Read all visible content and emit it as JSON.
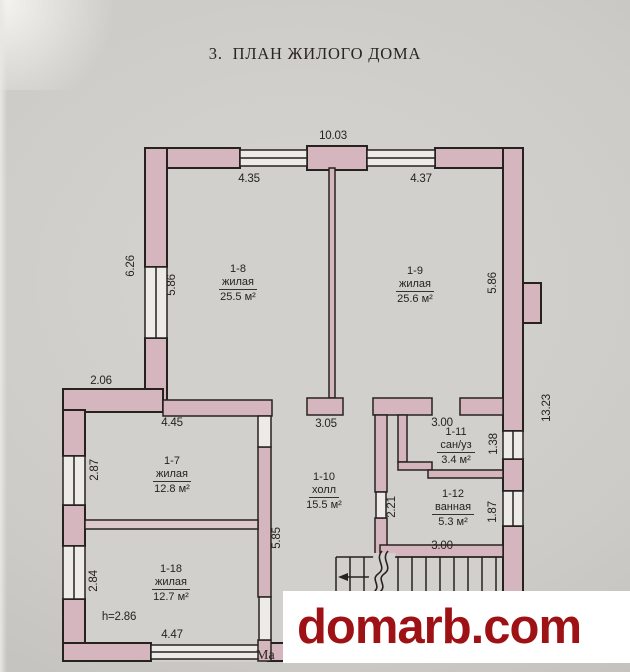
{
  "page": {
    "title": "3.  ПЛАН ЖИЛОГО ДОМА",
    "scale_note_partial": "Ма"
  },
  "watermark": {
    "text": "domarb.com",
    "color": "#9e1115",
    "background": "#ffffff"
  },
  "colors": {
    "paper": "#cdcbc7",
    "floor": "#d2d0cc",
    "wall_fill": "#d6b6be",
    "window_fill": "#edebe8",
    "line": "#26231f"
  },
  "rooms": {
    "r1_8": {
      "id": "1-8",
      "name": "жилая",
      "area": "25.5 м²"
    },
    "r1_9": {
      "id": "1-9",
      "name": "жилая",
      "area": "25.6 м²"
    },
    "r1_7": {
      "id": "1-7",
      "name": "жилая",
      "area": "12.8 м²"
    },
    "r1_10": {
      "id": "1-10",
      "name": "холл",
      "area": "15.5 м²"
    },
    "r1_11": {
      "id": "1-11",
      "name": "сан/уз",
      "area": "3.4 м²"
    },
    "r1_12": {
      "id": "1-12",
      "name": "ванная",
      "area": "5.3 м²"
    },
    "r1_18": {
      "id": "1-18",
      "name": "жилая",
      "area": "12.7 м²"
    }
  },
  "dimensions": {
    "top_overall": "10.03",
    "top_left_room": "4.35",
    "top_right_room": "4.37",
    "left_outer_upper": "6.26",
    "left_inner_upper": "5.86",
    "right_inner_upper": "5.86",
    "right_outer_overall": "13.23",
    "left_offset": "2.06",
    "room7_top_width": "4.45",
    "hall_top_width": "3.05",
    "sanuz_top_width": "3.00",
    "room7_left_height": "2.87",
    "sanuz_right_height": "1.38",
    "hall_mid_height": "2.21",
    "bath_right_height": "1.87",
    "room18_left_height": "2.84",
    "hall_wall_height": "5.85",
    "ceiling_height": "h=2.86",
    "room18_bottom_width": "4.47",
    "bath_bottom_width": "3.00"
  }
}
